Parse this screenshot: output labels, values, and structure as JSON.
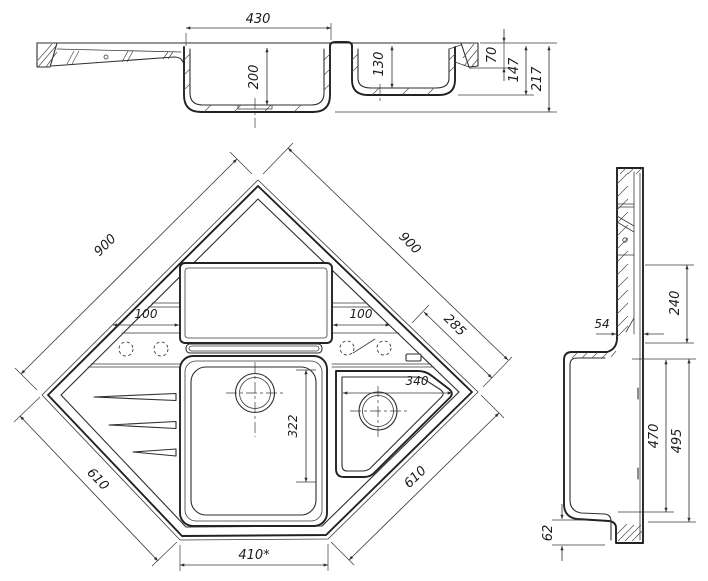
{
  "front_section": {
    "bowl_width": "430",
    "main_bowl_depth": "200",
    "second_bowl_depth": "130",
    "rim_height": "70",
    "mid_height": "147",
    "overall_height": "217"
  },
  "plan_view": {
    "upper_left_edge": "900",
    "upper_right_edge": "900",
    "corner_inset": "285",
    "left_deck_width": "100",
    "right_deck_width": "100",
    "small_bowl_width": "340",
    "main_bowl_length": "322",
    "lower_left_edge": "610",
    "lower_right_edge": "610",
    "front_edge_width": "410*"
  },
  "side_section": {
    "ledge_thickness": "54",
    "upper_height": "240",
    "bowl_depth": "470",
    "overall_depth": "495",
    "base_height": "62"
  }
}
